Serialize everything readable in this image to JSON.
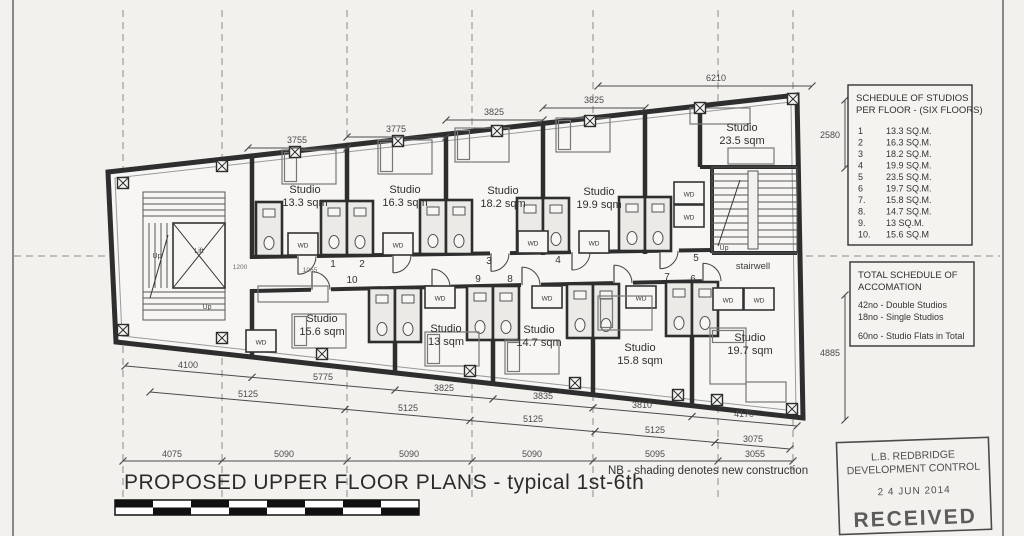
{
  "sheet": {
    "title": "PROPOSED UPPER FLOOR PLANS  - typical 1st-6th",
    "scale": "1:100",
    "note": "NB - shading denotes new construction"
  },
  "schedule_box": {
    "title_line1": "SCHEDULE OF STUDIOS",
    "title_line2": "PER FLOOR - (SIX FLOORS)",
    "rows": [
      {
        "no": "1",
        "area": "13.3 SQ.M."
      },
      {
        "no": "2",
        "area": "16.3 SQ.M."
      },
      {
        "no": "3",
        "area": "18.2 SQ.M."
      },
      {
        "no": "4",
        "area": "19.9 SQ.M."
      },
      {
        "no": "5",
        "area": "23.5 SQ.M."
      },
      {
        "no": "6",
        "area": "19.7 SQ.M."
      },
      {
        "no": "7.",
        "area": "15.8 SQ.M."
      },
      {
        "no": "8.",
        "area": "14.7 SQ.M."
      },
      {
        "no": "9.",
        "area": "13 SQ.M."
      },
      {
        "no": "10.",
        "area": "15.6 SQ.M"
      }
    ]
  },
  "total_box": {
    "title_line1": "TOTAL SCHEDULE OF",
    "title_line2": "ACCOMATION",
    "line1": "42no - Double Studios",
    "line2": "18no - Single Studios",
    "line3": "60no - Studio Flats in Total"
  },
  "stamp": {
    "line1": "L.B. REDBRIDGE",
    "line2": "DEVELOPMENT CONTROL",
    "date": "2 4  JUN  2014",
    "status": "RECEIVED"
  },
  "plan": {
    "rooms": [
      {
        "unit": "1",
        "name": "Studio",
        "area": "13.3 sqm"
      },
      {
        "unit": "2",
        "name": "Studio",
        "area": "16.3 sqm"
      },
      {
        "unit": "3",
        "name": "Studio",
        "area": "18.2 sqm"
      },
      {
        "unit": "4",
        "name": "Studio",
        "area": "19.9 sqm"
      },
      {
        "unit": "5",
        "name": "Studio",
        "area": "23.5 sqm"
      },
      {
        "unit": "6",
        "name": "Studio",
        "area": "19.7 sqm"
      },
      {
        "unit": "7",
        "name": "Studio",
        "area": "15.8 sqm"
      },
      {
        "unit": "8",
        "name": "Studio",
        "area": "14.7 sqm"
      },
      {
        "unit": "9",
        "name": "Studio",
        "area": "13 sqm"
      },
      {
        "unit": "10",
        "name": "Studio",
        "area": "15.6 sqm"
      }
    ],
    "labels": {
      "lift": "Lift",
      "up": "Up",
      "stairwell": "stairwell",
      "wd": "WD"
    },
    "dims": {
      "top": [
        "3755",
        "3775",
        "3825",
        "3825",
        "6210"
      ],
      "right_upper": "2580",
      "right_lower": "4885",
      "widths": [
        "4100",
        "5775",
        "3825",
        "3835",
        "3810",
        "4170"
      ],
      "grid_upper": [
        "5125",
        "5125",
        "5125",
        "5125",
        "3075"
      ],
      "grid_bottom": [
        "4075",
        "5090",
        "5090",
        "5090",
        "5095",
        "3055"
      ],
      "small": [
        "1200",
        "1065"
      ]
    }
  }
}
